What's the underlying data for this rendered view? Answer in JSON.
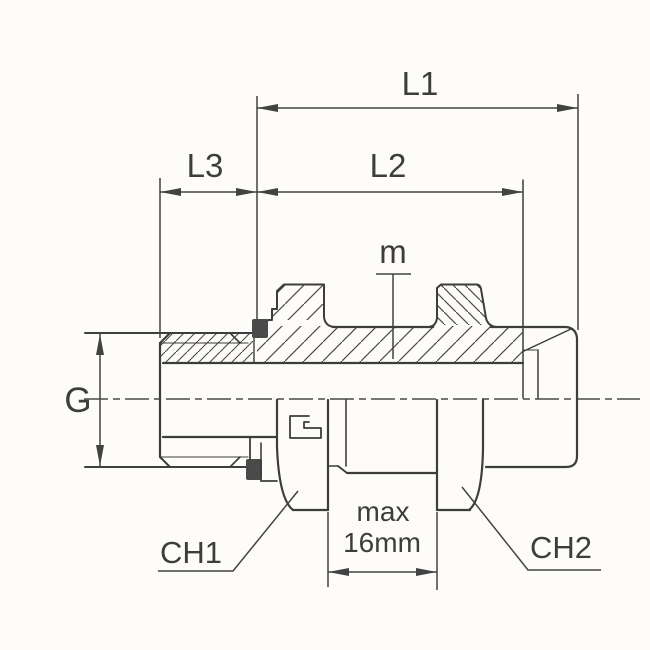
{
  "drawing": {
    "labels": {
      "l1": "L1",
      "l2": "L2",
      "l3": "L3",
      "g": "G",
      "m": "m",
      "ch1": "CH1",
      "ch2": "CH2",
      "max_line1": "max",
      "max_line2": "16mm"
    },
    "colors": {
      "background": "#fdfcf8",
      "line": "#3d3d3d",
      "dimension": "#424242",
      "seal": "#4a4a4a"
    }
  }
}
